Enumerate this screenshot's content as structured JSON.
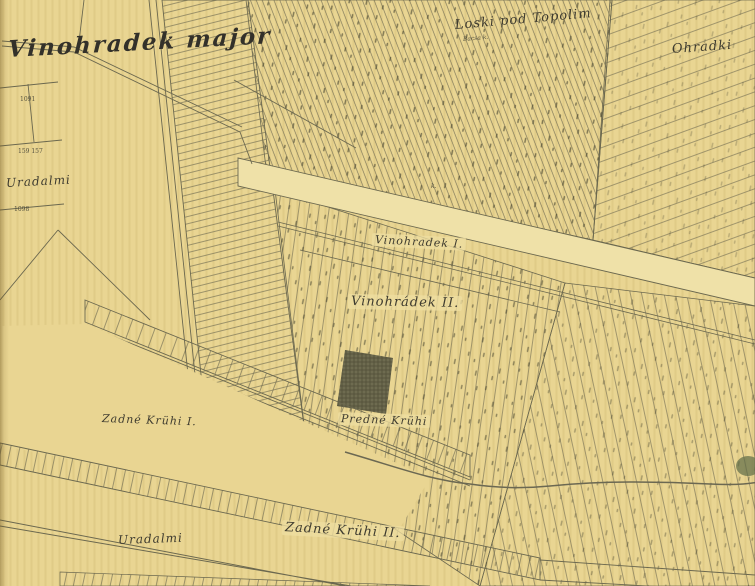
{
  "map": {
    "description": "Historical cadastral vineyard map, aged yellow paper with engraved strip parcels",
    "labels": {
      "title": "Vinohradek major",
      "loski": "Loski pod Topolim",
      "loski_sub": "Bacsa k.",
      "ohradki": "Ohradki",
      "uradalmi_left": "Uradalmi",
      "vinohradek_i": "Vinohradek I.",
      "vinohradek_ii": "Vinohrádek II.",
      "zadne_i": "Zadné Krühi I.",
      "predne": "Predné Krühi",
      "zadne_ii": "Zadné Krühi II.",
      "uradalmi_bottom": "Uradalmi"
    },
    "parcel_numbers": {
      "n1": "1091",
      "n2": "159 157",
      "n3": "1098",
      "marker_k": "k."
    },
    "colors": {
      "paper": "#e9d592",
      "paper_road": "#efe1a8",
      "ink_lines": "#6b684f",
      "ink_labels": "#3e3b2f",
      "dark_block": "#6e6b50",
      "green_blob": "#5e6b47"
    }
  }
}
